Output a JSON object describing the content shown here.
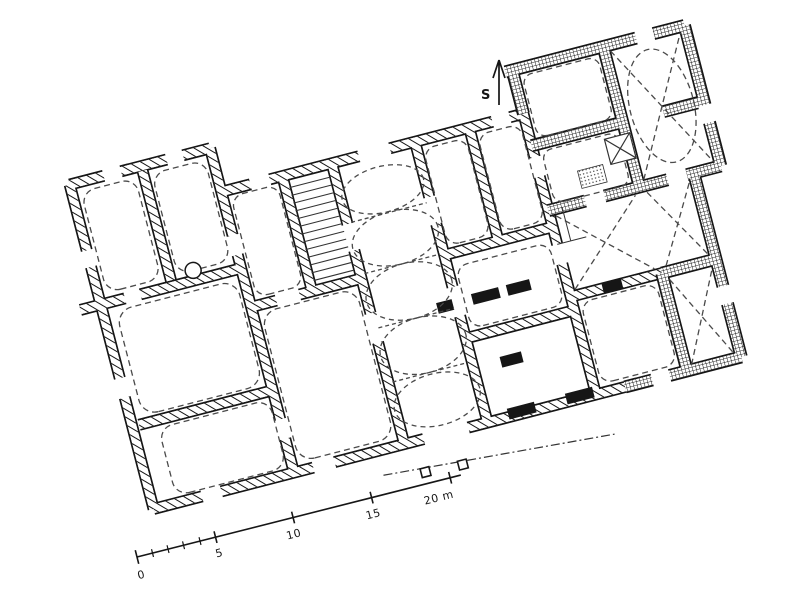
{
  "plan": {
    "kind": "scanned hand-drawn architectural ground plan of a tilted building complex",
    "north_arrow_label": "S",
    "scale_bar": {
      "tick_labels": [
        "0",
        "5",
        "10",
        "15"
      ],
      "end_label": "20 m"
    },
    "patterns_visible": [
      "diagonal-hatch-walls",
      "cross-hatch-walls",
      "solid-black-walls",
      "dashed-vault-lines"
    ],
    "colors": {
      "ink": "#161616",
      "detail": "#4a4a4a",
      "paper": "#ffffff"
    }
  }
}
